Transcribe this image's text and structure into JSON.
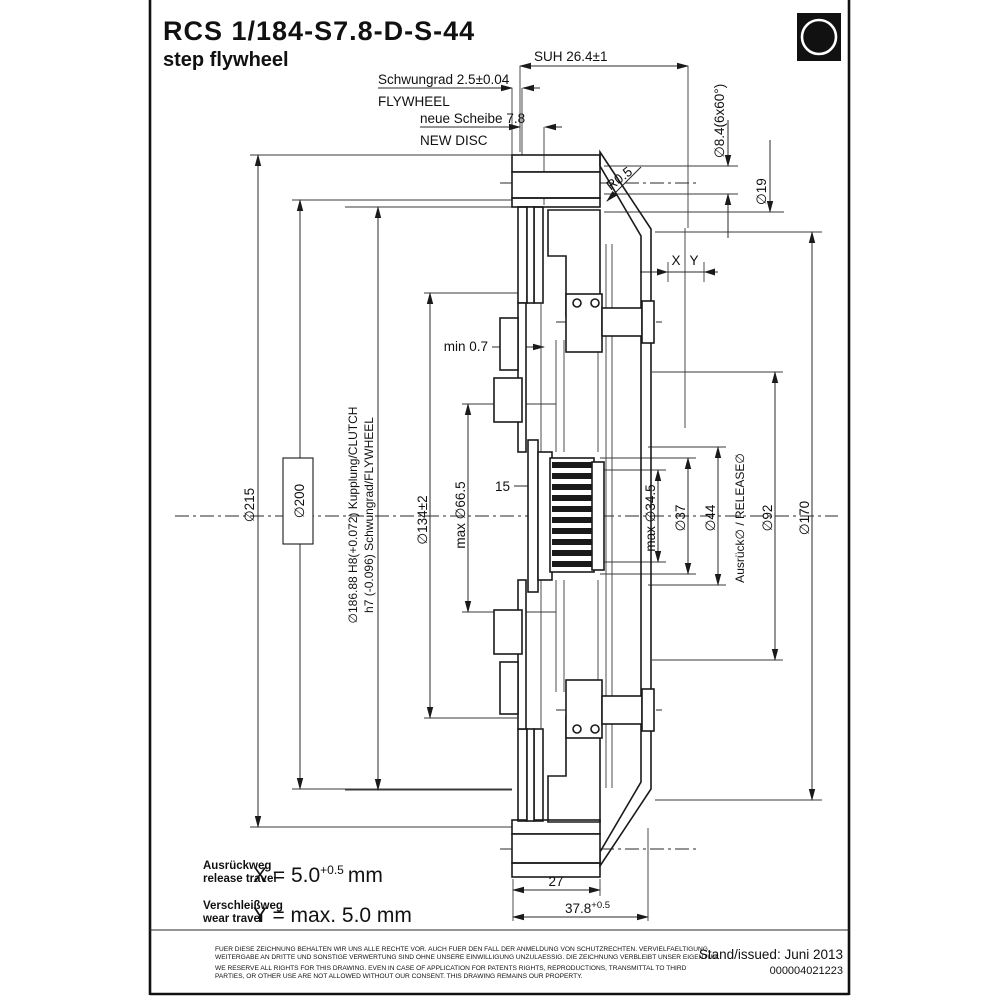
{
  "title_block": {
    "drawing_number": "RCS 1/184-S7.8-D-S-44",
    "drawing_name": "step flywheel",
    "logo_text": "ZF"
  },
  "top_dimensions": {
    "suh": "SUH 26.4±1",
    "flywheel_de": "Schwungrad 2.5±0.04",
    "flywheel_en": "FLYWHEEL",
    "new_disc_de": "neue Scheibe 7.8",
    "new_disc_en": "NEW DISC",
    "radius": "R0.5",
    "bolt_hole": "∅8.4(6x60°)",
    "counterbore": "∅19",
    "x_label": "X",
    "y_label": "Y"
  },
  "left_dimensions": {
    "d215": "∅215",
    "d200": "∅200",
    "d186_line1": "∅186.88 H8(+0.072)  Kupplung/CLUTCH",
    "d186_line2": "h7 (-0.096)  Schwungrad/FLYWHEEL",
    "d134": "∅134±2",
    "d66": "max ∅66.5",
    "spline_len": "15",
    "min_gap": "min 0.7"
  },
  "right_dimensions": {
    "d34": "max ∅34.5",
    "d37": "∅37",
    "d44": "∅44",
    "release": "Ausrück∅ / RELEASE∅",
    "d92": "∅92",
    "d170": "∅170"
  },
  "bottom_dimensions": {
    "w27": "27",
    "w378_base": "37.8",
    "w378_tol": "+0.5"
  },
  "travel_table": {
    "release_de": "Ausrückweg",
    "release_en": "release travel",
    "release_value": "X = 5.0",
    "release_tol": "+0.5",
    "release_unit": "mm",
    "wear_de": "Verschleißweg",
    "wear_en": "wear travel",
    "wear_value": "Y = max. 5.0 mm"
  },
  "footer": {
    "disclaimer_de_1": "FUER DIESE ZEICHNUNG BEHALTEN WIR UNS ALLE RECHTE VOR. AUCH FUER DEN FALL DER ANMELDUNG VON SCHUTZRECHTEN. VERVIELFAELTIGUNG,",
    "disclaimer_de_2": "WEITERGABE AN DRITTE UND SONSTIGE VERWERTUNG SIND OHNE UNSERE EINWILLIGUNG UNZULAESSIG. DIE ZEICHNUNG VERBLEIBT UNSER EIGENTUM.",
    "disclaimer_en_1": "WE RESERVE ALL RIGHTS FOR THIS DRAWING. EVEN IN CASE OF APPLICATION FOR PATENTS RIGHTS, REPRODUCTIONS, TRANSMITTAL TO THIRD",
    "disclaimer_en_2": "PARTIES, OR OTHER USE ARE NOT ALLOWED WITHOUT OUR CONSENT. THIS DRAWING REMAINS OUR PROPERTY.",
    "issued": "Stand/issued: Juni 2013",
    "doc_number": "000004021223"
  },
  "colors": {
    "line": "#1a1a1a",
    "background": "#ffffff"
  }
}
